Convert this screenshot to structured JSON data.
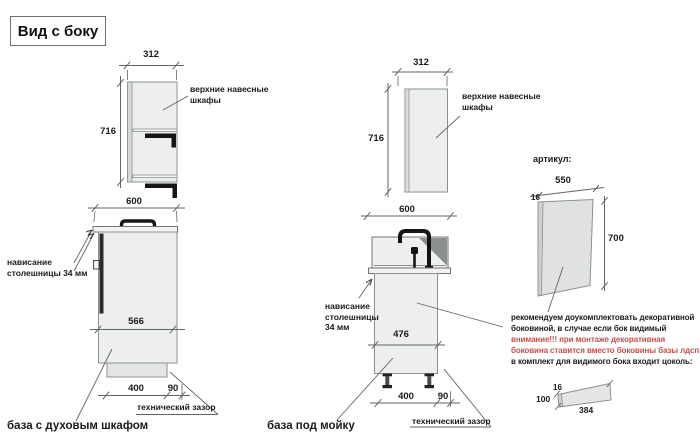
{
  "title": "Вид с боку",
  "colors": {
    "cabinet_fill": "#edefee",
    "outline_gray": "#8b9190",
    "dim_line_gray": "#5f6563",
    "black_parts": "#161616",
    "warning_red": "#c0504d",
    "text_black": "#1a1a1a"
  },
  "units": {
    "left": {
      "upper_width": "312",
      "upper_height": "716",
      "upper_label": "верхние навесные шкафы",
      "base_width": "600",
      "overhang_label": "нависание столешницы 34 мм",
      "base_depth": "566",
      "plinth_width": "400",
      "gap_width": "90",
      "gap_label": "технический зазор",
      "caption": "база с духовым шкафом"
    },
    "middle": {
      "upper_width": "312",
      "upper_height": "716",
      "upper_label": "верхние навесные шкафы",
      "base_width": "600",
      "overhang_label": "нависание столешницы 34 мм",
      "base_depth": "476",
      "plinth_width": "400",
      "gap_width": "90",
      "gap_label": "технический зазор",
      "caption": "база под мойку"
    }
  },
  "panel": {
    "heading": "артикул:",
    "width": "550",
    "thickness": "16",
    "height": "700",
    "note_line1": "рекомендуем доукомплектовать декоративной",
    "note_line2": "боковиной, в случае если бок видимый",
    "note_line3": "внимание!!! при монтаже декоративная",
    "note_line4": "боковина ставится вместо боковины базы лдсп",
    "note_line5": "в комплект для видимого бока входит цоколь:",
    "plinth_thickness": "16",
    "plinth_height": "100",
    "plinth_length": "384"
  }
}
